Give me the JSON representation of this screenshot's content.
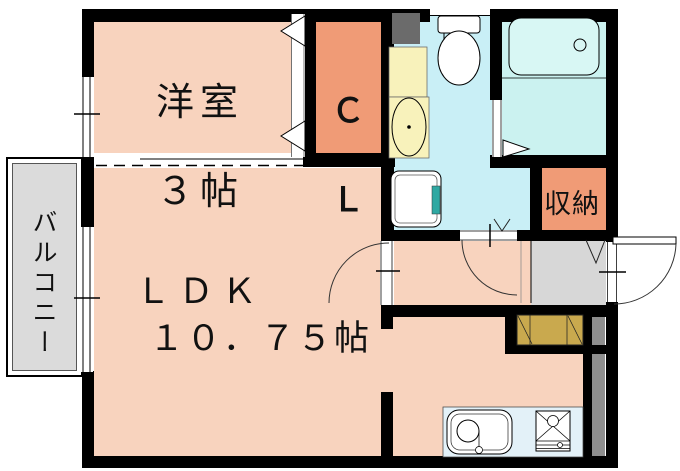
{
  "floorplan": {
    "type": "apartment-floor-plan",
    "rooms": {
      "western_room": {
        "label_line1": "洋室",
        "label_line2": "３帖"
      },
      "closet": {
        "label_line1": "Ｃ",
        "label_line2": "Ｌ"
      },
      "ldk": {
        "label_line1": "ＬＤＫ",
        "label_line2": "１０．７５帖"
      },
      "storage": {
        "label": "収納"
      },
      "balcony": {
        "label": "バルコニー"
      }
    },
    "fixtures": [
      "toilet",
      "bathtub",
      "washbasin",
      "washing-machine-pan",
      "kitchen-sink",
      "gas-stove",
      "shoe-cabinet",
      "pipe-space",
      "entrance-door",
      "room-door",
      "bath-folding-door",
      "closet-folding-doors",
      "window"
    ],
    "colors": {
      "wall": "#000000",
      "room_pink": "#F8D3BE",
      "closet_orange": "#F09B76",
      "sanitary_cyan": "#C9EFF6",
      "bath_cyan": "#CBF2F0",
      "bathtub_fill": "#D8F7F4",
      "washbasin_yellow": "#F8F2BB",
      "balcony_gray": "#DBDBDB",
      "entrance_gray": "#D7D7D7",
      "pipe_space_dark": "#6B6B6B",
      "pipe_space_gray": "#8E8E8E",
      "shoe_cabinet_tan": "#C9A94E",
      "kitchen_counter_blue": "#E3F1F8",
      "washer_pan_teal": "#2FA8A2"
    }
  }
}
